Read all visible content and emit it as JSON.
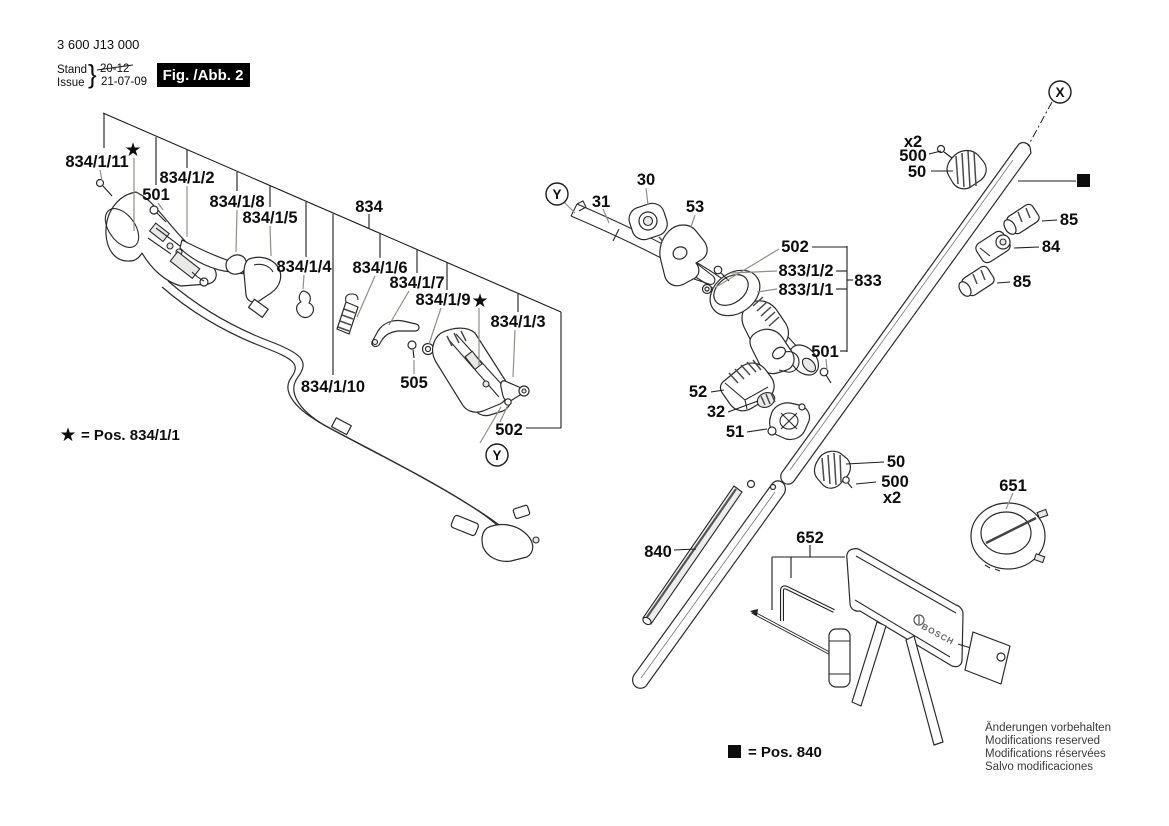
{
  "header": {
    "part_number": "3 600 J13 000",
    "stand_label": "Stand",
    "issue_label": "Issue",
    "brace": "}",
    "stand_value": "20-12",
    "issue_value": "21-07-09",
    "figure_label": "Fig. /Abb. 2"
  },
  "legend": {
    "star_symbol": "★",
    "star_text": "= Pos. 834/1/1",
    "square_symbol": "■",
    "square_text": "= Pos. 840"
  },
  "symbols": {
    "star": "★",
    "square": "■"
  },
  "connector_markers": {
    "x": "X",
    "y": "Y"
  },
  "brand": {
    "guard_logo": "BOSCH"
  },
  "callouts": {
    "834_1_11": "834/1/11",
    "501_left": "501",
    "834_1_2": "834/1/2",
    "834_1_8": "834/1/8",
    "834_1_5": "834/1/5",
    "834": "834",
    "834_1_4": "834/1/4",
    "834_1_6": "834/1/6",
    "834_1_7": "834/1/7",
    "834_1_9": "834/1/9",
    "834_1_3": "834/1/3",
    "834_1_10": "834/1/10",
    "505": "505",
    "502_left": "502",
    "31": "31",
    "30": "30",
    "53": "53",
    "502_mid": "502",
    "833_1_2": "833/1/2",
    "833_1_1": "833/1/1",
    "833": "833",
    "501_mid": "501",
    "52": "52",
    "32": "32",
    "51": "51",
    "50_low": "50",
    "500_low": "500",
    "x2_low": "x2",
    "840": "840",
    "652": "652",
    "651": "651",
    "x2_up": "x2",
    "500_up": "500",
    "50_up": "50",
    "85_up": "85",
    "84": "84",
    "85_low": "85"
  },
  "footer_notes": {
    "line1": "Änderungen vorbehalten",
    "line2": "Modifications reserved",
    "line3": "Modifications réservées",
    "line4": "Salvo modificaciones"
  }
}
